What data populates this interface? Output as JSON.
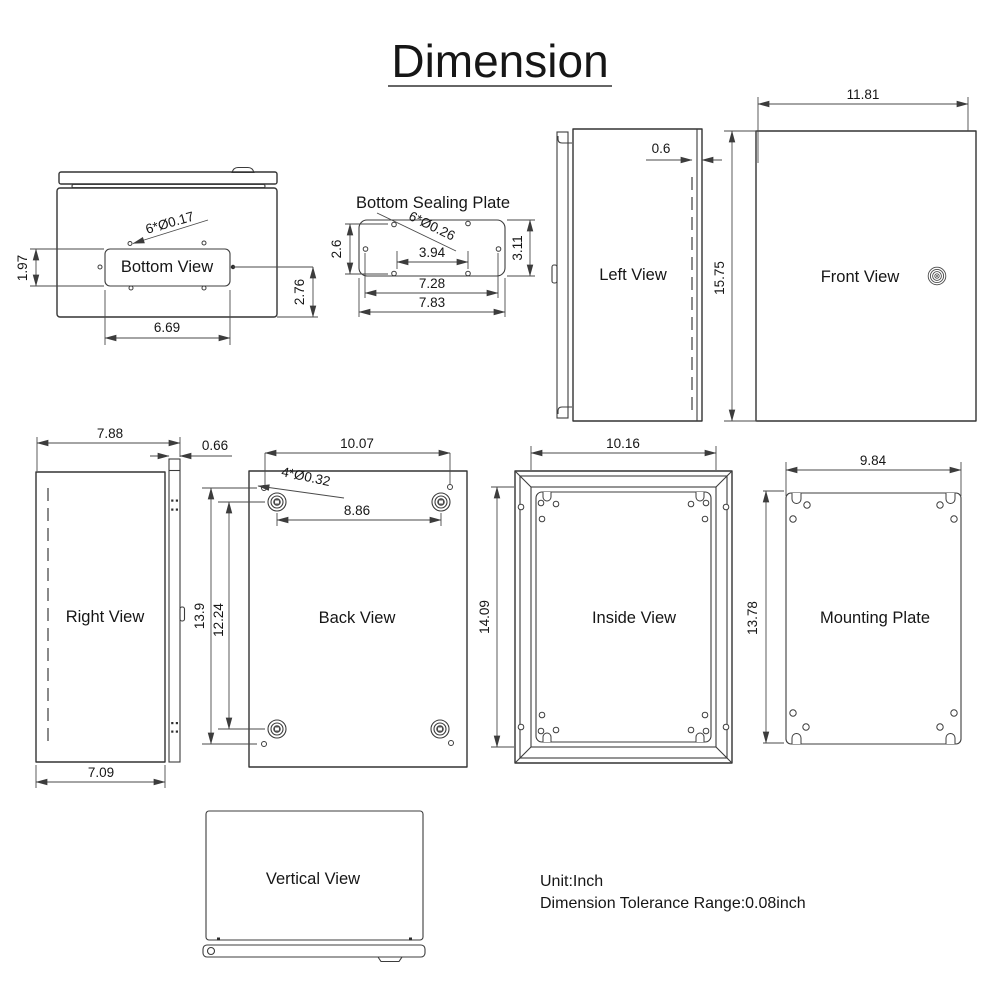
{
  "title": "Dimension",
  "bottom_view": {
    "label": "Bottom View",
    "hole_note": "6*Ø0.17",
    "height": "1.97",
    "width": "6.69",
    "offset": "2.76"
  },
  "sealing_plate": {
    "title": "Bottom Sealing Plate",
    "hole_note": "6*Ø0.26",
    "left_height": "2.6",
    "right_height": "3.11",
    "inner_width": "3.94",
    "mid_width": "7.28",
    "outer_width": "7.83"
  },
  "left_view": {
    "label": "Left View",
    "door_offset": "0.6"
  },
  "front_view": {
    "label": "Front View",
    "width": "11.81",
    "height": "15.75"
  },
  "right_view": {
    "label": "Right View",
    "depth": "7.88",
    "door_thickness": "0.66",
    "body_depth": "7.09"
  },
  "back_view": {
    "label": "Back View",
    "hole_note": "4*Ø0.32",
    "hole_width": "10.07",
    "boss_width": "8.86",
    "hole_height": "13.9",
    "boss_height": "12.24"
  },
  "inside_view": {
    "label": "Inside View",
    "width": "10.16",
    "height": "14.09"
  },
  "mounting_plate": {
    "label": "Mounting Plate",
    "width": "9.84",
    "height": "13.78"
  },
  "vertical_view": {
    "label": "Vertical View"
  },
  "footer": {
    "unit": "Unit:Inch",
    "tolerance": "Dimension Tolerance Range:0.08inch"
  }
}
